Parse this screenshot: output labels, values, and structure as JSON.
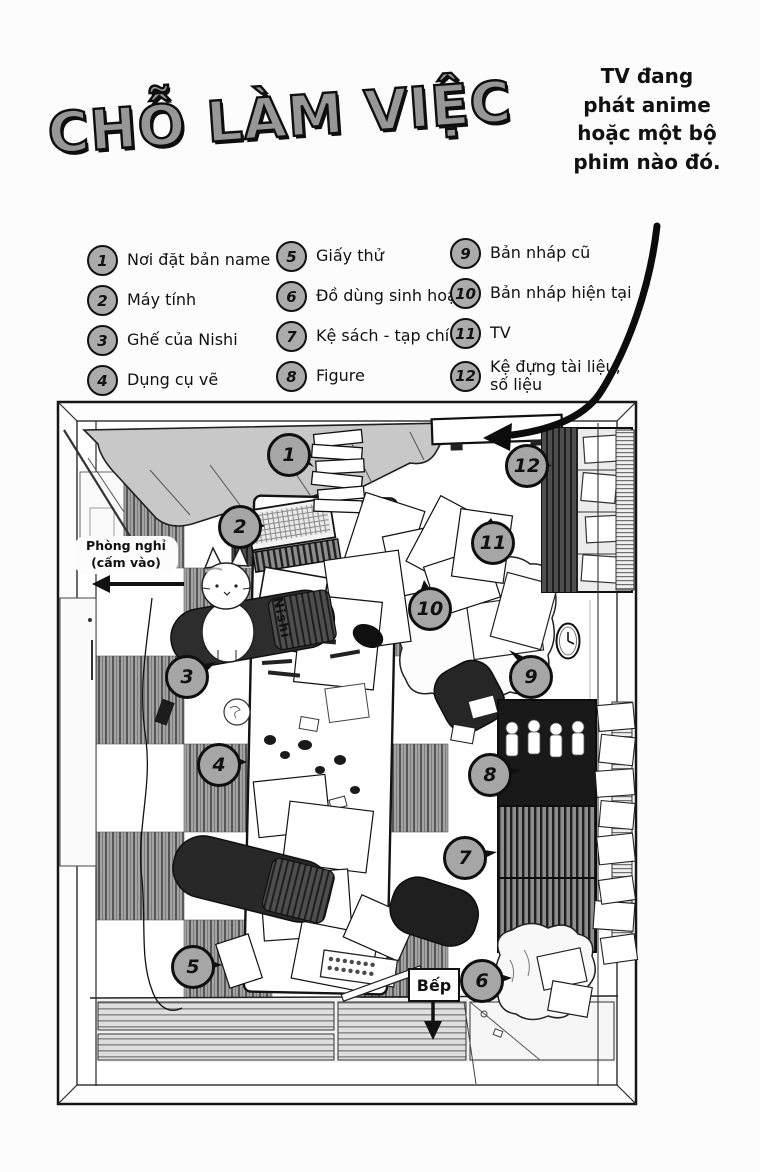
{
  "page": {
    "title": "CHỖ LÀM VIỆC"
  },
  "note": {
    "lines": [
      "TV đang",
      "phát anime",
      "hoặc một bộ",
      "phim nào đó."
    ]
  },
  "legend": {
    "items": [
      {
        "n": "1",
        "label": "Nơi đặt bản name"
      },
      {
        "n": "2",
        "label": "Máy tính"
      },
      {
        "n": "3",
        "label": "Ghế của Nishi"
      },
      {
        "n": "4",
        "label": "Dụng cụ vẽ"
      },
      {
        "n": "5",
        "label": "Giấy thử"
      },
      {
        "n": "6",
        "label": "Đồ dùng sinh hoạt"
      },
      {
        "n": "7",
        "label": "Kệ sách - tạp chí"
      },
      {
        "n": "8",
        "label": "Figure"
      },
      {
        "n": "9",
        "label": "Bản nháp cũ"
      },
      {
        "n": "10",
        "label": "Bản nháp hiện tại"
      },
      {
        "n": "11",
        "label": "TV"
      },
      {
        "n": "12",
        "label": "Kệ đựng tài liệu, số liệu"
      }
    ]
  },
  "diagram": {
    "markers": [
      "1",
      "2",
      "3",
      "4",
      "5",
      "6",
      "7",
      "8",
      "9",
      "10",
      "11",
      "12"
    ],
    "rest_label_line1": "Phòng nghỉ",
    "rest_label_line2": "(cấm vào)",
    "kitchen_label": "Bếp",
    "nameplate": "Nishi"
  },
  "colors": {
    "ink": "#111111",
    "title_fill": "#979797",
    "marker_fill": "#a6a6a6",
    "legend_circle_fill": "#ababab",
    "curtain": "#c8c8c8"
  }
}
